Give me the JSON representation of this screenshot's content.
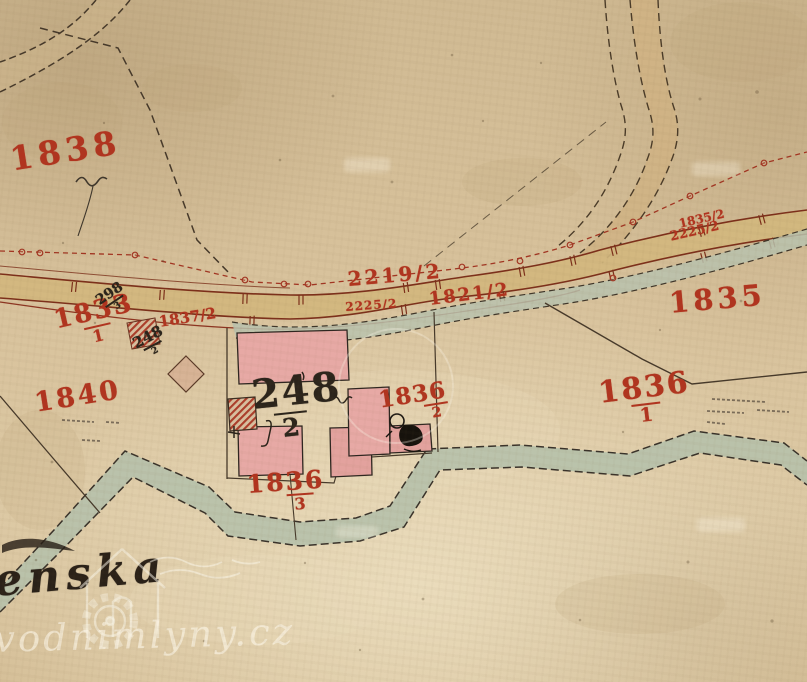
{
  "map": {
    "kind": "historical cadastral map scan",
    "place_label": "enska",
    "watermark": {
      "site_label": "vodnimlyny.cz"
    },
    "colors": {
      "paper": "#d8c29c",
      "red_ink": "#b1341f",
      "black_ink": "#2b241b",
      "road_fill": "#d3b77e",
      "road_edge": "#7c2f1a",
      "stream_fill": "#b7c1ac",
      "building_fill": "#e7a9a5",
      "hatch_red": "#ac3d2a",
      "watermark_white": "#faf6e8"
    },
    "symbols": {
      "watermill": "circle-with-wheel-blob",
      "meadow": "grass-tuft-squiggle"
    },
    "parcel_labels": [
      {
        "id": "1838",
        "num": "1838",
        "x": 8,
        "y": 145,
        "size": 33,
        "rot": -9,
        "ink": "red",
        "ls": 5
      },
      {
        "id": "1833-1",
        "num": "1833",
        "den": "1",
        "x": 52,
        "y": 310,
        "size": 26,
        "rot": -13,
        "ink": "red",
        "ls": 2
      },
      {
        "id": "298-3",
        "num": "298",
        "den": "3",
        "x": 94,
        "y": 297,
        "size": 14,
        "rot": -34,
        "ink": "black"
      },
      {
        "id": "1837-2",
        "num": "1837/2",
        "x": 158,
        "y": 316,
        "size": 15,
        "rot": -9,
        "ink": "red"
      },
      {
        "id": "248-2-small",
        "num": "248",
        "den": "2",
        "x": 131,
        "y": 339,
        "size": 15,
        "rot": -28,
        "ink": "black"
      },
      {
        "id": "248-2",
        "num": "248",
        "den": "2",
        "den_dx": -8,
        "x": 250,
        "y": 378,
        "size": 40,
        "rot": -6,
        "ink": "black",
        "ls": 2
      },
      {
        "id": "2219-2",
        "num": "2219/2",
        "x": 347,
        "y": 270,
        "size": 20,
        "rot": -5,
        "ink": "red",
        "ls": 3
      },
      {
        "id": "2225-2-road",
        "num": "2225/2",
        "x": 345,
        "y": 302,
        "size": 12,
        "rot": -4,
        "ink": "red",
        "ls": 1
      },
      {
        "id": "1821-2",
        "num": "1821/2",
        "x": 428,
        "y": 292,
        "size": 18,
        "rot": -7,
        "ink": "red",
        "ls": 2
      },
      {
        "id": "1835-2",
        "num": "1835/2",
        "x": 678,
        "y": 219,
        "size": 12,
        "rot": -13,
        "ink": "red"
      },
      {
        "id": "2225-2-east",
        "num": "2225/2",
        "x": 669,
        "y": 232,
        "size": 13,
        "rot": -13,
        "ink": "red"
      },
      {
        "id": "1835",
        "num": "1835",
        "x": 668,
        "y": 290,
        "size": 29,
        "rot": -5,
        "ink": "red",
        "ls": 4
      },
      {
        "id": "1840",
        "num": "1840",
        "x": 33,
        "y": 392,
        "size": 27,
        "rot": -9,
        "ink": "red",
        "ls": 3
      },
      {
        "id": "1836-2",
        "num": "1836",
        "den": "2",
        "den_dx": 22,
        "x": 377,
        "y": 390,
        "size": 23,
        "rot": -9,
        "ink": "red",
        "ls": 1
      },
      {
        "id": "1836-1",
        "num": "1836",
        "den": "1",
        "x": 597,
        "y": 380,
        "size": 30,
        "rot": -7,
        "ink": "red",
        "ls": 2
      },
      {
        "id": "1836-3",
        "num": "1836",
        "den": "3",
        "den_dx": 14,
        "x": 246,
        "y": 473,
        "size": 25,
        "rot": -4,
        "ink": "red",
        "ls": 2
      }
    ]
  }
}
